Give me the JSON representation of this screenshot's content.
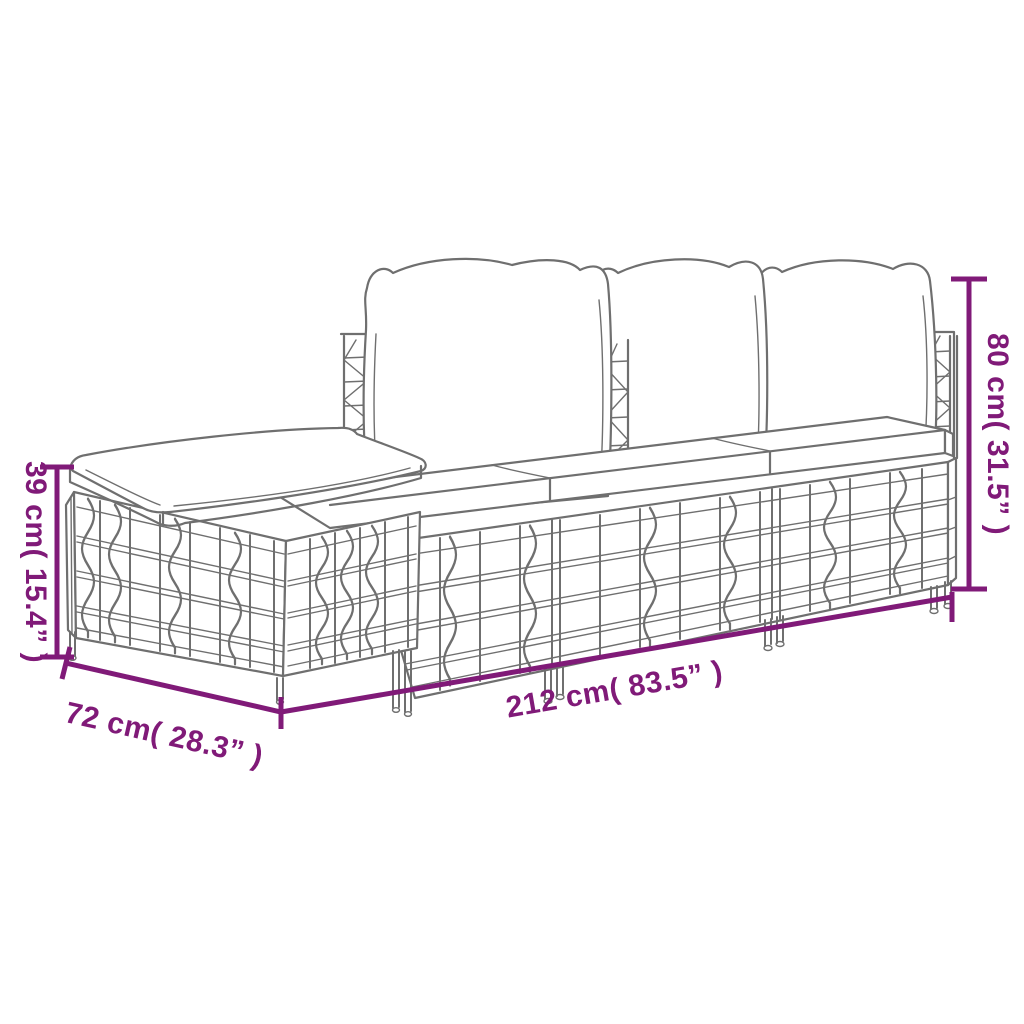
{
  "diagram": {
    "illustration": "rattan-garden-lounge-set-line-drawing",
    "background_color": "#ffffff",
    "artwork_line_color": "#6f6f6f",
    "dimension_color": "#801a78",
    "dimensions": {
      "height": {
        "label": "80 cm( 31.5” )"
      },
      "seat_height": {
        "label": "39 cm( 15.4” )"
      },
      "depth": {
        "label": "72 cm( 28.3” )"
      },
      "length": {
        "label": "212 cm( 83.5” )"
      }
    }
  }
}
